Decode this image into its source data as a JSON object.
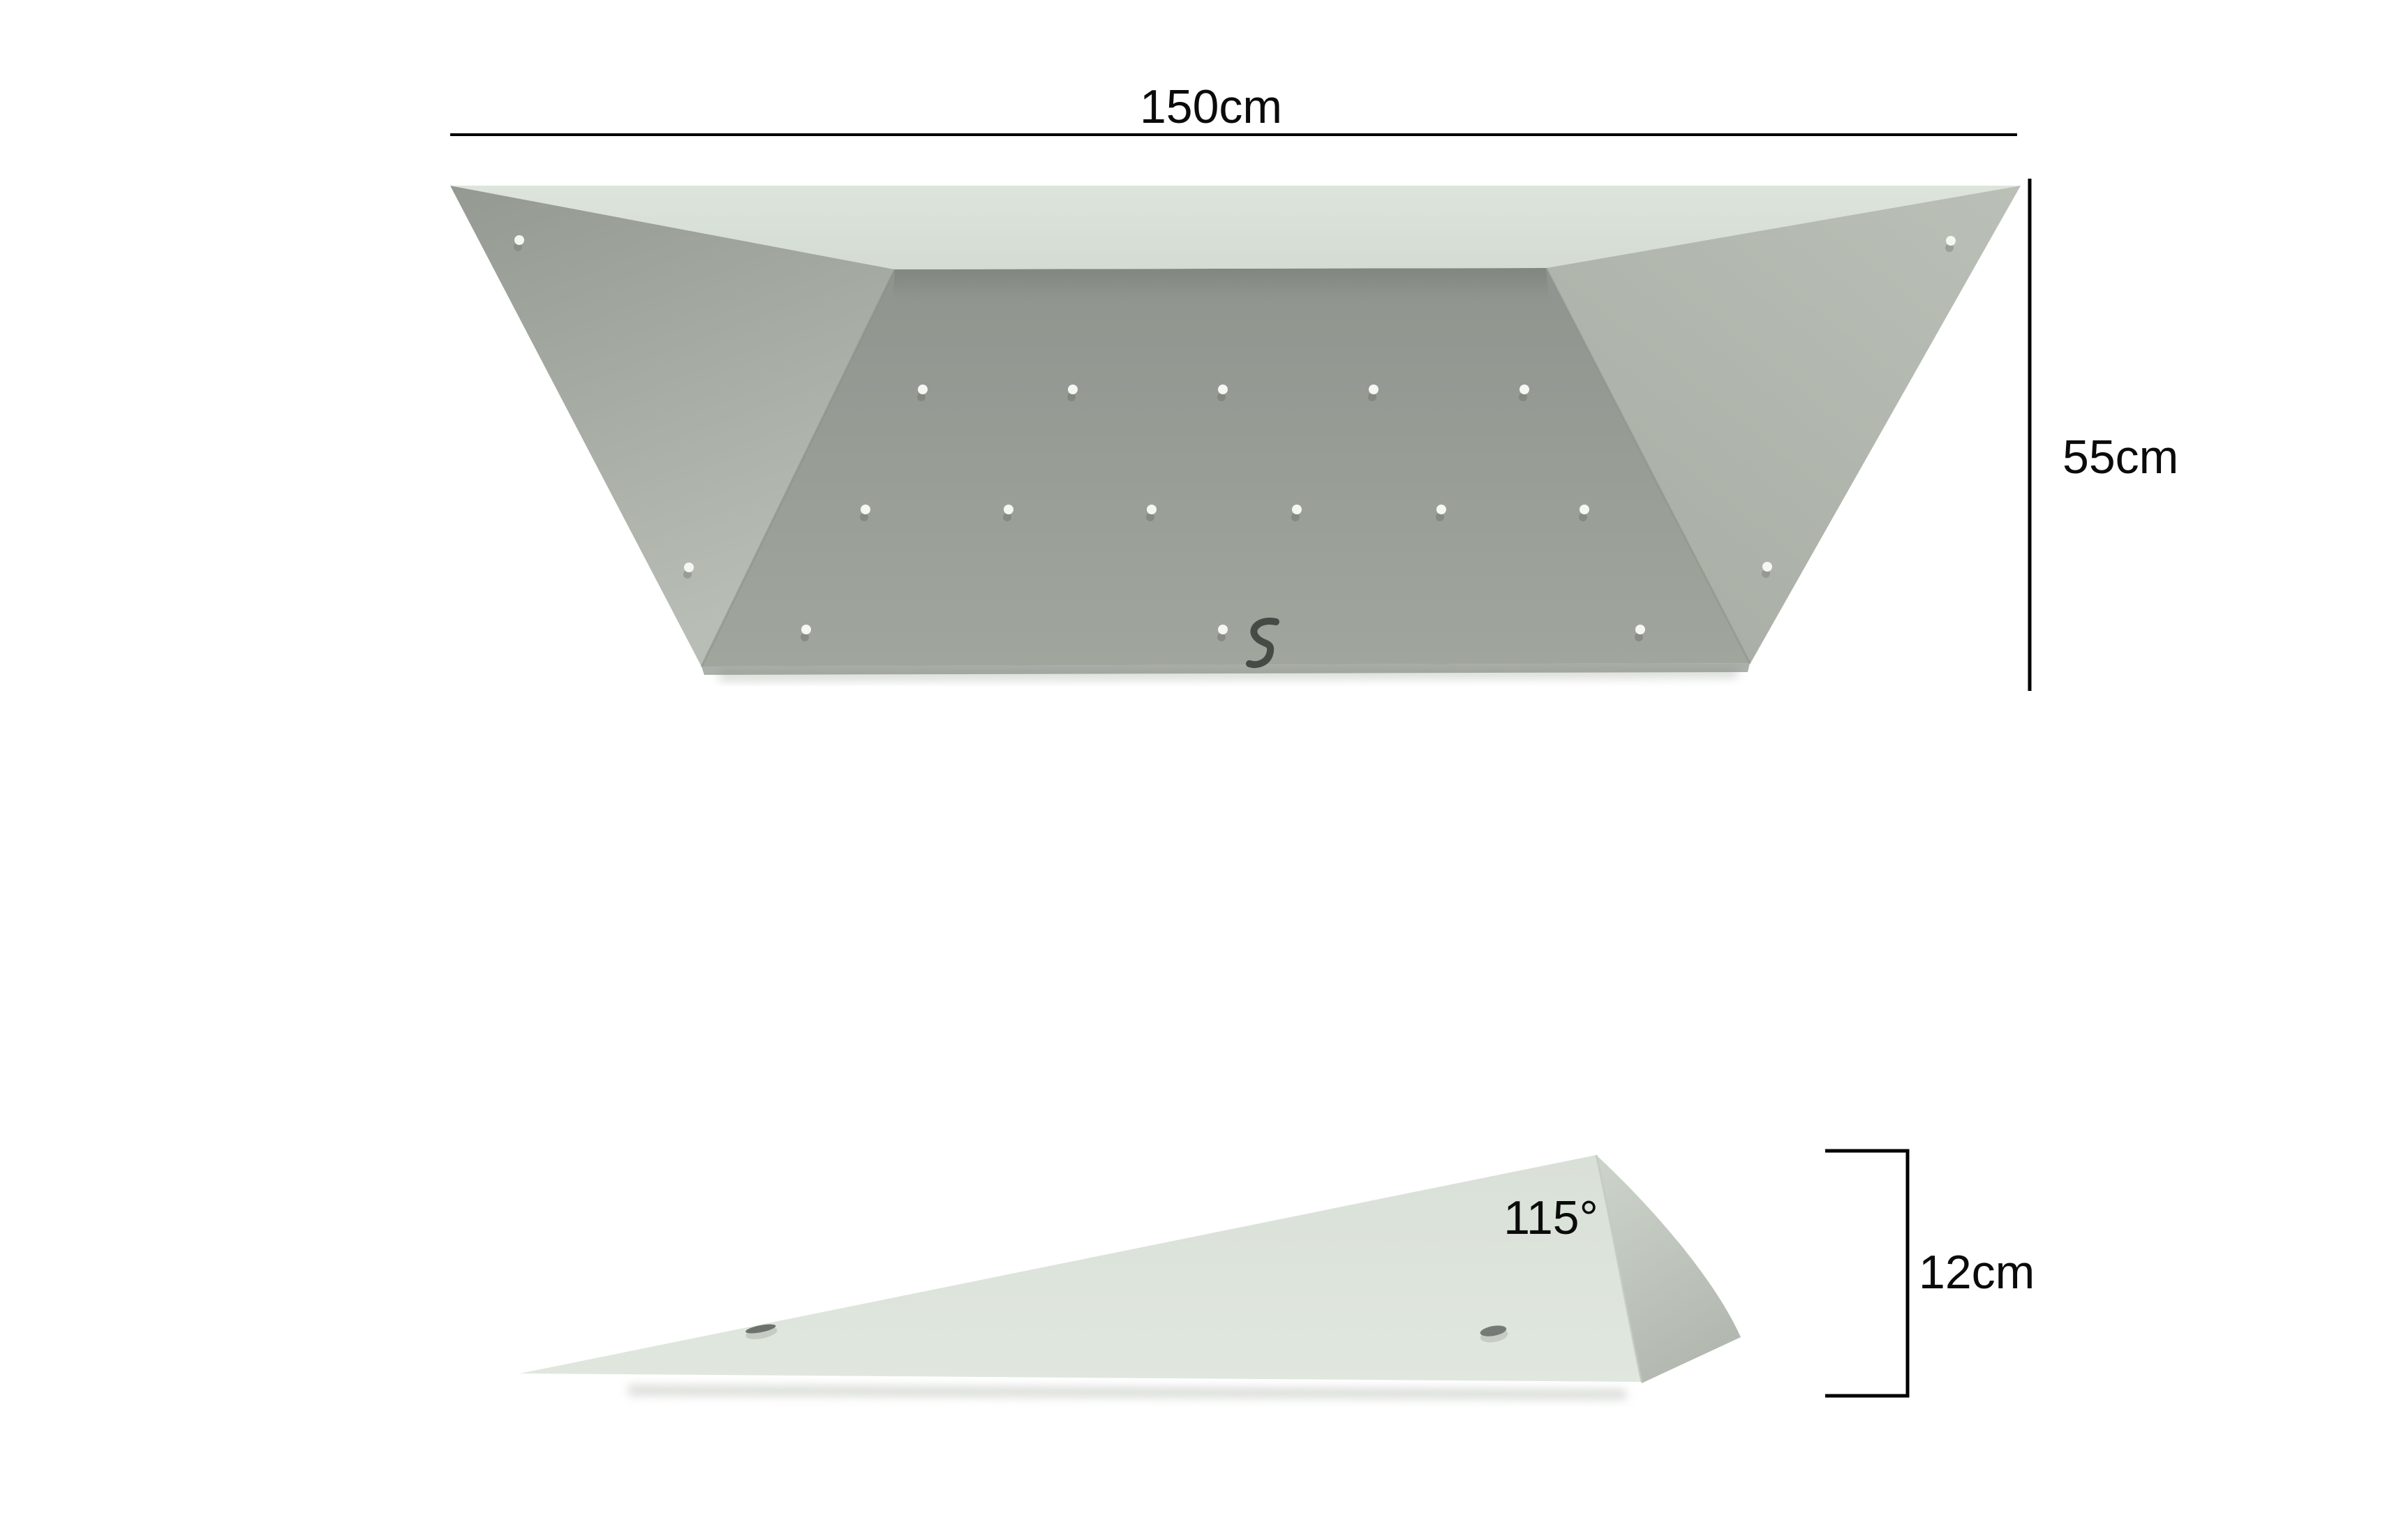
{
  "drawing": {
    "background": "#ffffff",
    "line_color": "#000000",
    "top_view": {
      "width_label": "150cm",
      "height_label": "55cm",
      "colors": {
        "top_face": "#dae1d9",
        "left_face_top": "#949a92",
        "left_face_bottom": "#b8beb5",
        "right_face_top": "#bac0b7",
        "right_face_bottom": "#a8aea5",
        "front_face_top": "#8f958e",
        "front_face_bottom": "#a0a69d",
        "hole": "#f4f7f3",
        "logo": "#454b45"
      },
      "hole_counts": {
        "front_face": 14,
        "left_face": 2,
        "right_face": 2
      }
    },
    "side_view": {
      "angle_label": "115°",
      "depth_label": "12cm",
      "colors": {
        "main_face": "#dce3db",
        "right_facet_top": "#cdd4cb",
        "right_facet_bottom": "#b3b9b0"
      },
      "hole_counts": {
        "profile": 2
      }
    }
  }
}
